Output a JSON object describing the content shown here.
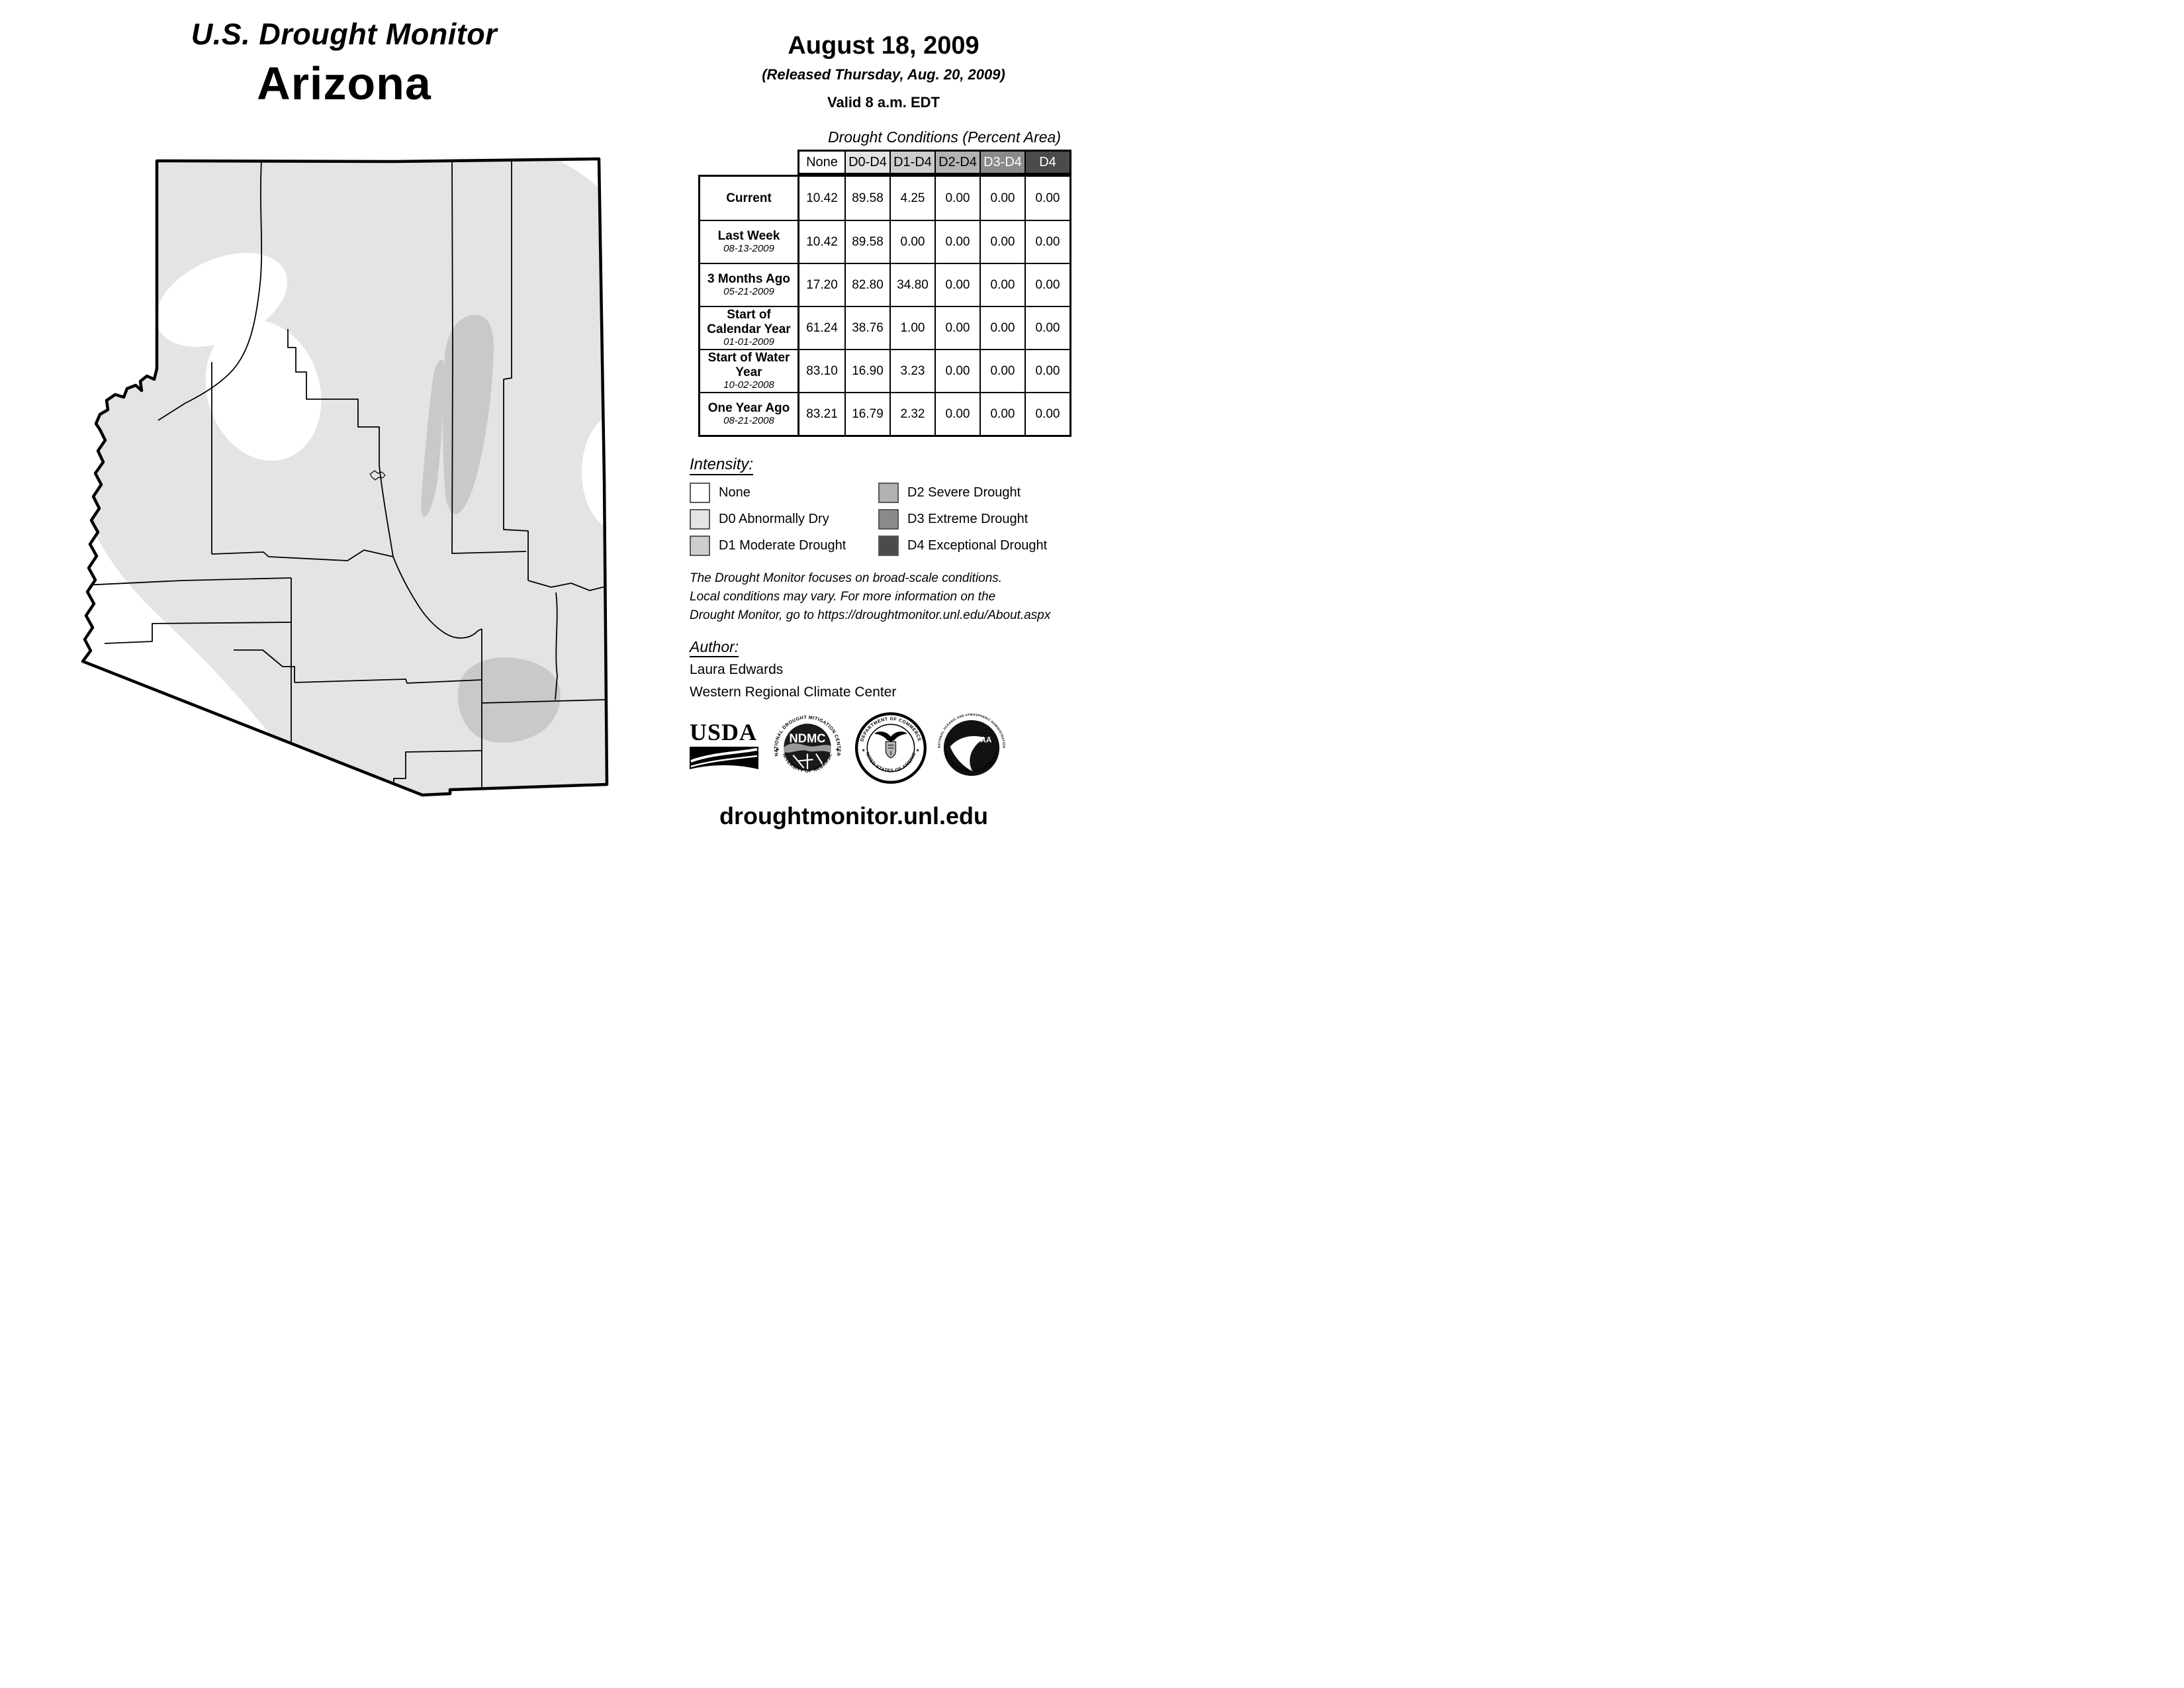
{
  "header": {
    "title": "U.S. Drought Monitor",
    "region": "Arizona",
    "date": "August 18, 2009",
    "released": "(Released Thursday, Aug. 20, 2009)",
    "valid": "Valid 8 a.m. EDT"
  },
  "table": {
    "caption": "Drought Conditions (Percent Area)",
    "columns": [
      "None",
      "D0-D4",
      "D1-D4",
      "D2-D4",
      "D3-D4",
      "D4"
    ],
    "column_colors": [
      "#ffffff",
      "#e4e4e4",
      "#cdcdcd",
      "#b2b2b2",
      "#8a8a8a",
      "#4b4b4b"
    ],
    "column_text_colors": [
      "#000000",
      "#000000",
      "#000000",
      "#000000",
      "#ffffff",
      "#ffffff"
    ],
    "rows": [
      {
        "label": "Current",
        "date": "",
        "values": [
          "10.42",
          "89.58",
          "4.25",
          "0.00",
          "0.00",
          "0.00"
        ]
      },
      {
        "label": "Last Week",
        "date": "08-13-2009",
        "values": [
          "10.42",
          "89.58",
          "0.00",
          "0.00",
          "0.00",
          "0.00"
        ]
      },
      {
        "label": "3 Months Ago",
        "date": "05-21-2009",
        "values": [
          "17.20",
          "82.80",
          "34.80",
          "0.00",
          "0.00",
          "0.00"
        ]
      },
      {
        "label": "Start of Calendar Year",
        "date": "01-01-2009",
        "values": [
          "61.24",
          "38.76",
          "1.00",
          "0.00",
          "0.00",
          "0.00"
        ]
      },
      {
        "label": "Start of Water Year",
        "date": "10-02-2008",
        "values": [
          "83.10",
          "16.90",
          "3.23",
          "0.00",
          "0.00",
          "0.00"
        ]
      },
      {
        "label": "One Year Ago",
        "date": "08-21-2008",
        "values": [
          "83.21",
          "16.79",
          "2.32",
          "0.00",
          "0.00",
          "0.00"
        ]
      }
    ]
  },
  "legend": {
    "title": "Intensity:",
    "items": [
      {
        "label": "None",
        "color": "#ffffff"
      },
      {
        "label": "D0 Abnormally Dry",
        "color": "#e4e4e4"
      },
      {
        "label": "D1 Moderate Drought",
        "color": "#cdcdcd"
      },
      {
        "label": "D2 Severe Drought",
        "color": "#b2b2b2"
      },
      {
        "label": "D3 Extreme Drought",
        "color": "#8a8a8a"
      },
      {
        "label": "D4 Exceptional Drought",
        "color": "#4b4b4b"
      }
    ]
  },
  "disclaimer": {
    "lines": [
      "The Drought Monitor focuses on broad-scale conditions.",
      "Local conditions may vary. For more information on the",
      "Drought Monitor, go to https://droughtmonitor.unl.edu/About.aspx"
    ]
  },
  "author": {
    "title": "Author:",
    "name": "Laura Edwards",
    "org": "Western Regional Climate Center"
  },
  "logos": {
    "usda": {
      "label": "USDA"
    },
    "ndmc": {
      "arc_top": "NATIONAL DROUGHT MITIGATION CENTER",
      "arc_bottom": "UNIVERSITY OF NEBRASKA",
      "center": "NDMC"
    },
    "commerce": {
      "arc_top": "DEPARTMENT OF COMMERCE",
      "arc_bottom": "UNITED STATES OF AMERICA"
    },
    "noaa": {
      "arc_top": "NATIONAL OCEANIC AND ATMOSPHERIC ADMINISTRATION",
      "arc_bottom": "U.S. DEPARTMENT OF COMMERCE",
      "center": "NOAA"
    }
  },
  "footer": {
    "website": "droughtmonitor.unl.edu"
  },
  "map": {
    "colors": {
      "none": "#ffffff",
      "d0": "#e4e4e4",
      "d1": "#c9c9c9",
      "border": "#000000"
    }
  }
}
